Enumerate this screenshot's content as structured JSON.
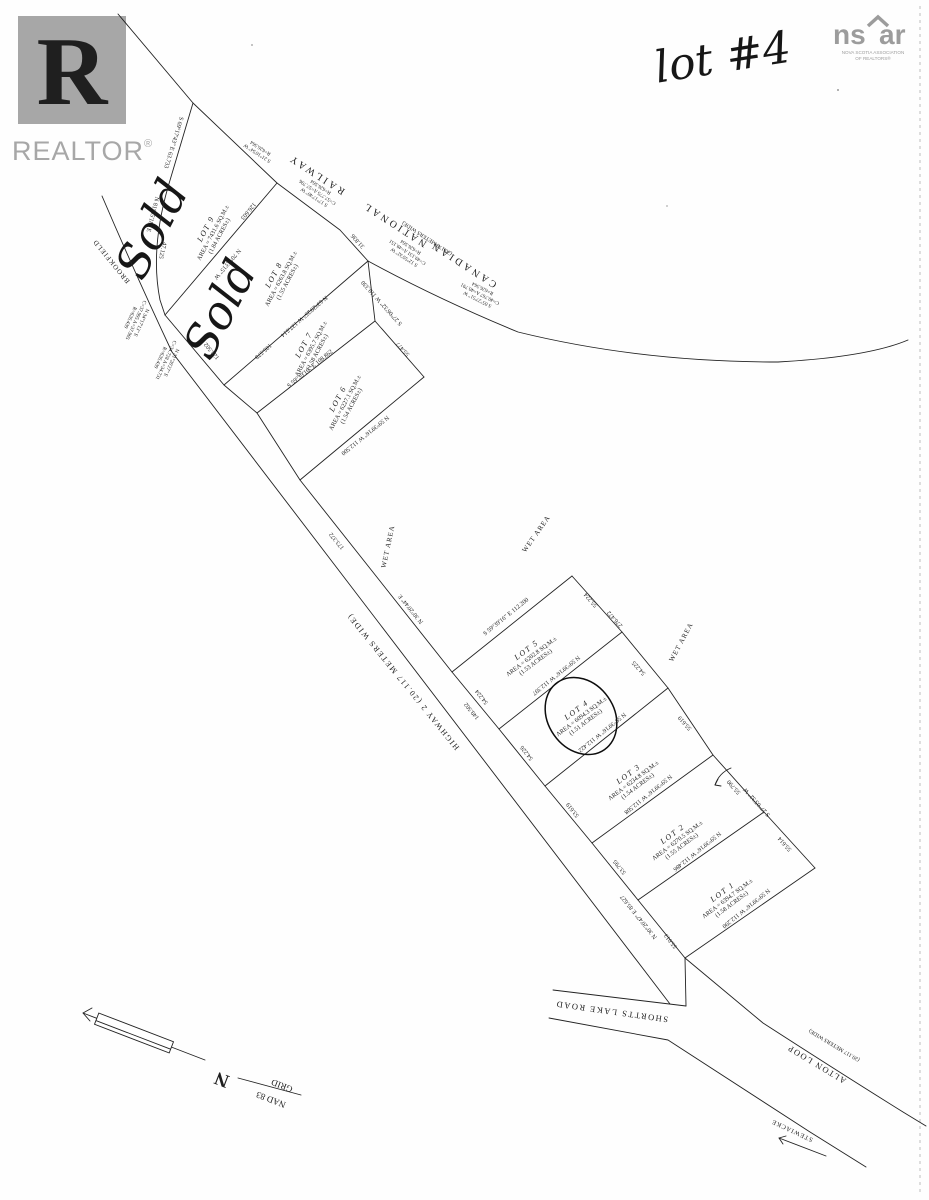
{
  "colors": {
    "ink": "#1f1f1f",
    "logo_grey": "#a7a7a7",
    "nsar_grey": "#9c9c9c"
  },
  "branding": {
    "realtor_r": "R",
    "realtor_word": "REALTOR",
    "reg": "®",
    "ns": "ns",
    "ar": "ar",
    "tag1": "NOVA SCOTIA ASSOCIATION",
    "tag2": "OF REALTORS®"
  },
  "annotation": {
    "handwritten_note": "lot #4",
    "sold_1": "Sold",
    "sold_2": "Sold"
  },
  "north_indicator": {
    "n": "N",
    "grid": "GRID",
    "datum": "NAD 83"
  },
  "t": {
    "railway_canadian": "CANADIAN",
    "railway_national": "NATIONAL",
    "railway_railway": "RAILWAY",
    "railway_width": "(20.178 METERS WIDE)",
    "cb1_l1": "S 21°16'54\" W",
    "cb1_l2": "R=626.564",
    "cb2_l1": "S 17°17'40\" W",
    "cb2_l2": "C=57.775  A=57.796",
    "cb2_l3": "R=626.564",
    "cb3_l1": "S 12°55'32\" W",
    "cb3_l2": "C=49.131  A=49.151",
    "cb3_l3": "R=626.564",
    "cb4_l1": "S 05°27'51\" W",
    "cb4_l2": "C=40.767  A=40.791",
    "cb4_l3": "R=626.564",
    "wb1_l1": "N 34°17'13\" E",
    "wb1_l2": "C=37.995  A=37.905",
    "wb1_l3": "R=626.439",
    "wb2_l1": "N 31°26'27\" E",
    "wb2_l2": "C=34.728  A=34.731",
    "wb2_l3": "R=626.439",
    "d_128502": "128.502",
    "brookfield": "BROOKFIELD",
    "b_s691743": "S 69°17'43\" E  63.733",
    "b_n813518": "N 81°35'18\" E",
    "d_47125": "47.125",
    "d_126603": "126.603",
    "b_n704315": "N 70°43'15\" W",
    "b_n632925": "N 63°29'25\" W  137.514",
    "d_105578": "105.578",
    "b_s593916_108": "S 59°39'16\" E  108.862",
    "b_n593916_1125": "N 59°39'16\" W  112.500",
    "d_55477": "55.477",
    "b_s270632": "S 27°06'32\" W  119.330",
    "d_31836": "31.836",
    "lot9_name": "LOT 9",
    "lot9_area": "AREA = 7431.6 SQ.M.±",
    "lot9_acres": "(1.84 ACRES±)",
    "lot8_name": "LOT 8",
    "lot8_area": "AREA = 6263.8 SQ.M.±",
    "lot8_acres": "(1.55 ACRES±)",
    "lot7_name": "LOT 7",
    "lot7_area": "AREA = 6395.7 SQ.M.±",
    "lot7_acres": "(1.58 ACRES±)",
    "lot6_name": "LOT 6",
    "lot6_area": "AREA = 6227.1 SQ.M.±",
    "lot6_acres": "(1.54 ACRES±)",
    "lot5_name": "LOT 5",
    "lot5_area": "AREA = 6202.8 SQ.M.±",
    "lot5_acres": "(1.53 ACRES±)",
    "lot4_name": "LOT 4",
    "lot4_area": "AREA = 6094.3 SQ.M.±",
    "lot4_acres": "(1.51 ACRES±)",
    "lot3_name": "LOT 3",
    "lot3_area": "AREA = 6234.8 SQ.M.±",
    "lot3_acres": "(1.54 ACRES±)",
    "lot2_name": "LOT 2",
    "lot2_area": "AREA = 6270.5 SQ.M.±",
    "lot2_acres": "(1.55 ACRES±)",
    "lot1_name": "LOT 1",
    "lot1_area": "AREA = 6394.7 SQ.M.±",
    "lot1_acres": "(1.58 ACRES±)",
    "highway_label": "HIGHWAY 2  (20.117 METERS WIDE)",
    "b_n302044": "N 30°20'44\" E",
    "d_173372": "173.372",
    "b_s593916_1122": "S 59°39'16\" E  112.200",
    "b_l45": "N 59°39'16\" W  112.397",
    "b_l34": "N 59°39'16\" W  112.422",
    "b_l23": "N 59°39'16\" W  112.508",
    "b_l12": "N 59°39'16\" W  112.486",
    "b_l1s": "N 59°39'16\" W  112.290",
    "d_54224": "54.224",
    "d_149502": "149.502",
    "d_54226": "54.226",
    "d_53619": "53.619",
    "d_53795": "53.795",
    "d_55013": "55.013",
    "b_n302047": "N 30°20'47\" E  85.627",
    "d_55224": "55.224",
    "d_276472": "276.472",
    "d_54225": "54.225",
    "d_55619": "55.619",
    "d_55790": "55.790",
    "d_55614": "55.614",
    "b_s270532": "S 27°05'32\" W",
    "wet_1": "WET AREA",
    "wet_2": "WET AREA",
    "wet_3": "WET AREA",
    "shortts": "SHORTTS LAKE ROAD",
    "alton": "ALTON LOOP",
    "alton_width": "(20.117 METERS WIDE)",
    "stewiacke": "STEWIACKE"
  }
}
